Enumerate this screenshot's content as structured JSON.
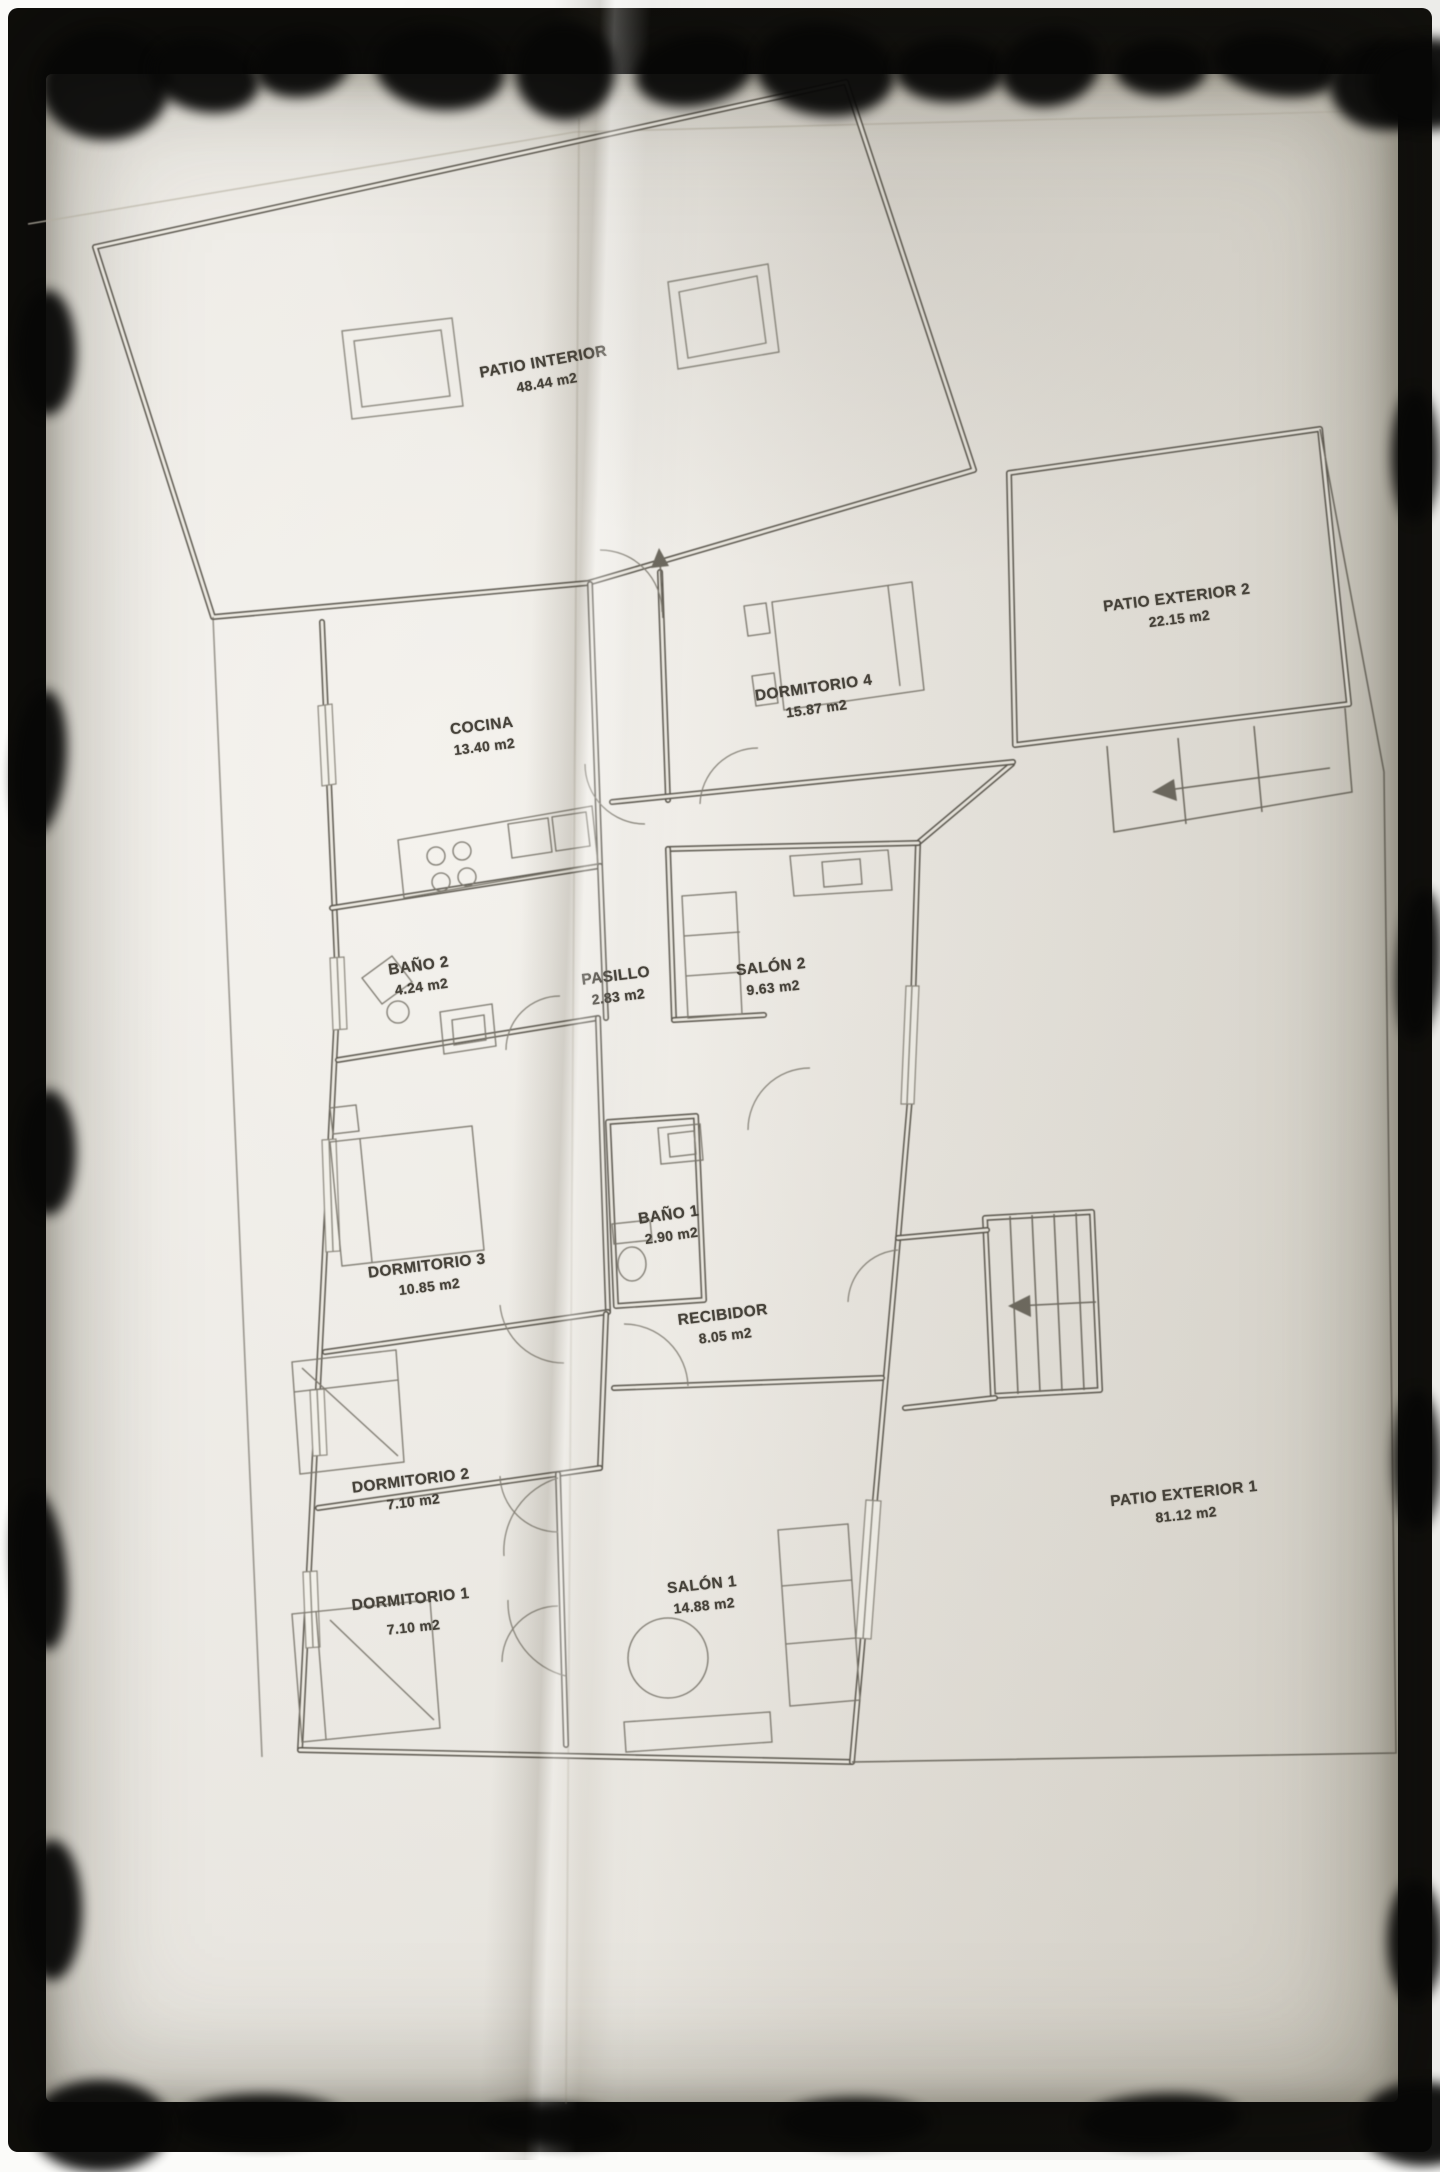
{
  "plan": {
    "rooms": [
      {
        "id": "patio-interior",
        "name": "PATIO INTERIOR",
        "area": "48.44 m2"
      },
      {
        "id": "patio-exterior-2",
        "name": "PATIO EXTERIOR 2",
        "area": "22.15 m2"
      },
      {
        "id": "dormitorio-4",
        "name": "DORMITORIO 4",
        "area": "15.87 m2"
      },
      {
        "id": "cocina",
        "name": "COCINA",
        "area": "13.40 m2"
      },
      {
        "id": "bano-2",
        "name": "BAÑO 2",
        "area": "4.24 m2"
      },
      {
        "id": "pasillo",
        "name": "PASILLO",
        "area": "2.83 m2"
      },
      {
        "id": "salon-2",
        "name": "SALÓN 2",
        "area": "9.63 m2"
      },
      {
        "id": "bano-1",
        "name": "BAÑO 1",
        "area": "2.90 m2"
      },
      {
        "id": "dormitorio-3",
        "name": "DORMITORIO 3",
        "area": "10.85 m2"
      },
      {
        "id": "recibidor",
        "name": "RECIBIDOR",
        "area": "8.05 m2"
      },
      {
        "id": "dormitorio-2",
        "name": "DORMITORIO 2",
        "area": "7.10 m2"
      },
      {
        "id": "dormitorio-1",
        "name": "DORMITORIO 1",
        "area": "7.10 m2"
      },
      {
        "id": "salon-1",
        "name": "SALÓN 1",
        "area": "14.88 m2"
      },
      {
        "id": "patio-exterior-1",
        "name": "PATIO EXTERIOR 1",
        "area": "81.12 m2"
      }
    ]
  },
  "colors": {
    "paper": "#ece8e0",
    "ink": "#59554c",
    "frame": "#0a0a09"
  }
}
